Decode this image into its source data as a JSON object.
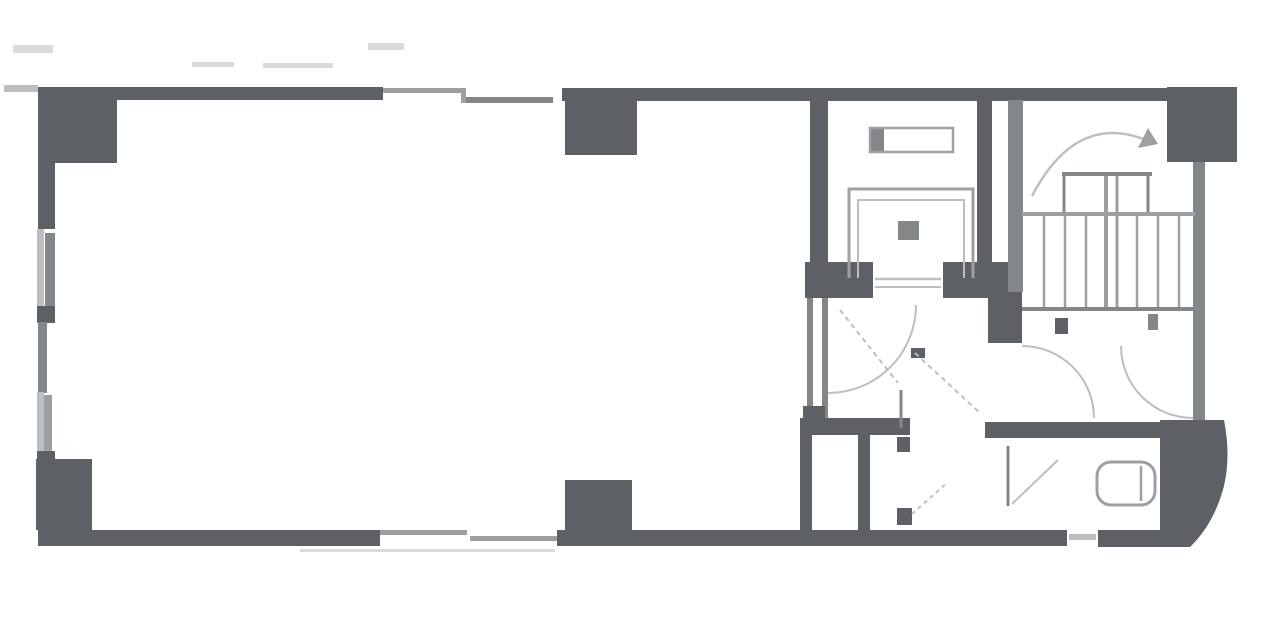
{
  "canvas": {
    "width": 1280,
    "height": 632,
    "background": "#ffffff"
  },
  "colors": {
    "dark": "#5d6064",
    "med": "#84878a",
    "medlt": "#9da0a3",
    "lt": "#bcbfc2",
    "faint": "#d8dadc",
    "white": "#ffffff"
  },
  "walls": [
    {
      "name": "column-top-left",
      "x": 38,
      "y": 87,
      "w": 79,
      "h": 76,
      "c": "dark"
    },
    {
      "name": "wall-left-upper",
      "x": 38,
      "y": 163,
      "w": 17,
      "h": 66,
      "c": "dark"
    },
    {
      "name": "window-left-upper-outer",
      "x": 37,
      "y": 229,
      "w": 7,
      "h": 80,
      "c": "lt"
    },
    {
      "name": "window-left-upper-inner",
      "x": 45,
      "y": 233,
      "w": 10,
      "h": 74,
      "c": "med"
    },
    {
      "name": "wall-left-jamb-upper",
      "x": 37,
      "y": 306,
      "w": 18,
      "h": 17,
      "c": "dark"
    },
    {
      "name": "wall-left-middle",
      "x": 38,
      "y": 322,
      "w": 9,
      "h": 71,
      "c": "med"
    },
    {
      "name": "window-left-lower-outer",
      "x": 37,
      "y": 392,
      "w": 7,
      "h": 64,
      "c": "lt"
    },
    {
      "name": "window-left-lower-inner",
      "x": 44,
      "y": 395,
      "w": 8,
      "h": 59,
      "c": "medlt"
    },
    {
      "name": "wall-left-jamb-lower",
      "x": 37,
      "y": 451,
      "w": 18,
      "h": 13,
      "c": "dark"
    },
    {
      "name": "column-bottom-left",
      "x": 36,
      "y": 459,
      "w": 56,
      "h": 71,
      "c": "dark"
    },
    {
      "name": "wall-top-left-segment",
      "x": 38,
      "y": 87,
      "w": 345,
      "h": 13,
      "c": "dark"
    },
    {
      "name": "wall-top-right-segment",
      "x": 562,
      "y": 88,
      "w": 605,
      "h": 13,
      "c": "dark"
    },
    {
      "name": "column-top-middle",
      "x": 565,
      "y": 88,
      "w": 72,
      "h": 67,
      "c": "dark"
    },
    {
      "name": "column-top-right",
      "x": 1167,
      "y": 87,
      "w": 70,
      "h": 75,
      "c": "dark"
    },
    {
      "name": "wall-bottom-left-segment",
      "x": 38,
      "y": 530,
      "w": 342,
      "h": 16,
      "c": "dark"
    },
    {
      "name": "wall-bottom-middle-segment",
      "x": 557,
      "y": 530,
      "w": 510,
      "h": 16,
      "c": "dark"
    },
    {
      "name": "wall-bottom-vent-gap",
      "x": 1067,
      "y": 530,
      "w": 31,
      "h": 16,
      "c": "white"
    },
    {
      "name": "wall-bottom-vent-line",
      "x": 1069,
      "y": 534,
      "w": 27,
      "h": 6,
      "c": "lt"
    },
    {
      "name": "wall-bottom-right-segment",
      "x": 1098,
      "y": 530,
      "w": 64,
      "h": 17,
      "c": "dark"
    },
    {
      "name": "column-bottom-middle",
      "x": 565,
      "y": 480,
      "w": 67,
      "h": 53,
      "c": "dark"
    },
    {
      "name": "wall-elevator-left",
      "x": 810,
      "y": 100,
      "w": 18,
      "h": 167,
      "c": "dark"
    },
    {
      "name": "wall-elevator-right",
      "x": 977,
      "y": 100,
      "w": 15,
      "h": 162,
      "c": "dark"
    },
    {
      "name": "elevator-door-jamb-left",
      "x": 805,
      "y": 262,
      "w": 68,
      "h": 36,
      "c": "dark"
    },
    {
      "name": "elevator-door-jamb-right",
      "x": 943,
      "y": 262,
      "w": 67,
      "h": 36,
      "c": "dark"
    },
    {
      "name": "wall-hall-left-a",
      "x": 807,
      "y": 298,
      "w": 6,
      "h": 122,
      "c": "med"
    },
    {
      "name": "wall-hall-left-b",
      "x": 822,
      "y": 298,
      "w": 6,
      "h": 122,
      "c": "med"
    },
    {
      "name": "wall-hall-junction",
      "x": 803,
      "y": 406,
      "w": 22,
      "h": 14,
      "c": "dark"
    },
    {
      "name": "wall-bathroom-top-left",
      "x": 800,
      "y": 418,
      "w": 110,
      "h": 17,
      "c": "dark"
    },
    {
      "name": "wall-anteroom-left",
      "x": 800,
      "y": 435,
      "w": 12,
      "h": 95,
      "c": "dark"
    },
    {
      "name": "wall-bathroom-left",
      "x": 858,
      "y": 435,
      "w": 12,
      "h": 95,
      "c": "dark"
    },
    {
      "name": "bathroom-partition-top",
      "x": 897,
      "y": 437,
      "w": 13,
      "h": 15,
      "c": "dark"
    },
    {
      "name": "bathroom-partition-bottom",
      "x": 897,
      "y": 508,
      "w": 15,
      "h": 17,
      "c": "dark"
    },
    {
      "name": "wall-bathroom-top-right",
      "x": 985,
      "y": 422,
      "w": 222,
      "h": 16,
      "c": "dark"
    },
    {
      "name": "wall-stair-left",
      "x": 1008,
      "y": 100,
      "w": 15,
      "h": 192,
      "c": "med"
    },
    {
      "name": "wall-stair-left-block",
      "x": 988,
      "y": 292,
      "w": 34,
      "h": 51,
      "c": "dark"
    },
    {
      "name": "wall-right",
      "x": 1193,
      "y": 162,
      "w": 12,
      "h": 260,
      "c": "med"
    },
    {
      "name": "balcony-stub-left",
      "x": 4,
      "y": 85,
      "w": 34,
      "h": 7,
      "c": "lt"
    },
    {
      "name": "dimension-mark-1",
      "x": 13,
      "y": 45,
      "w": 40,
      "h": 8,
      "c": "faint"
    },
    {
      "name": "dimension-mark-2",
      "x": 368,
      "y": 43,
      "w": 36,
      "h": 7,
      "c": "faint"
    },
    {
      "name": "dimension-mark-3",
      "x": 192,
      "y": 62,
      "w": 42,
      "h": 5,
      "c": "faint"
    },
    {
      "name": "dimension-mark-4",
      "x": 263,
      "y": 63,
      "w": 70,
      "h": 5,
      "c": "faint"
    },
    {
      "name": "window-top-outer",
      "x": 383,
      "y": 88,
      "w": 82,
      "h": 5,
      "c": "medlt"
    },
    {
      "name": "window-top-inner",
      "x": 463,
      "y": 97,
      "w": 90,
      "h": 6,
      "c": "med"
    },
    {
      "name": "window-top-joint",
      "x": 461,
      "y": 88,
      "w": 5,
      "h": 15,
      "c": "medlt"
    },
    {
      "name": "window-bottom-outer",
      "x": 380,
      "y": 530,
      "w": 87,
      "h": 5,
      "c": "medlt"
    },
    {
      "name": "window-bottom-inner",
      "x": 470,
      "y": 536,
      "w": 87,
      "h": 5,
      "c": "medlt"
    },
    {
      "name": "window-bottom-under-line",
      "x": 300,
      "y": 549,
      "w": 255,
      "h": 3,
      "c": "faint"
    },
    {
      "name": "hall-door-stub",
      "x": 911,
      "y": 348,
      "w": 14,
      "h": 10,
      "c": "dark"
    },
    {
      "name": "stair-door-stub-left",
      "x": 1055,
      "y": 318,
      "w": 13,
      "h": 16,
      "c": "dark"
    },
    {
      "name": "stair-door-stub-right",
      "x": 1148,
      "y": 314,
      "w": 10,
      "h": 16,
      "c": "med"
    },
    {
      "name": "elevator-handle",
      "x": 898,
      "y": 221,
      "w": 21,
      "h": 19,
      "c": "med"
    },
    {
      "name": "counterweight-cap",
      "x": 870,
      "y": 128,
      "w": 14,
      "h": 24,
      "c": "med"
    }
  ],
  "vectors": [
    {
      "name": "bathroom-corner-block",
      "tag": "path",
      "attrs": {
        "d": "M1160,420 L1224,420 Q1231,455 1224,486 Q1214,524 1190,547 L1160,547 Z",
        "fill": "dark",
        "stroke": "none"
      }
    },
    {
      "name": "elevator-counterweight",
      "tag": "rect",
      "attrs": {
        "x": "870",
        "y": "128",
        "width": "83",
        "height": "24",
        "fill": "none",
        "stroke": "medlt",
        "stroke-width": "2.5"
      }
    },
    {
      "name": "elevator-car-outer",
      "tag": "path",
      "attrs": {
        "d": "M849,278 V189 H973 V278",
        "fill": "none",
        "stroke": "medlt",
        "stroke-width": "3"
      }
    },
    {
      "name": "elevator-car-inner",
      "tag": "path",
      "attrs": {
        "d": "M858,278 V200 H964 V278",
        "fill": "none",
        "stroke": "lt",
        "stroke-width": "2"
      }
    },
    {
      "name": "elevator-door-line-1",
      "tag": "line",
      "attrs": {
        "x1": "875",
        "y1": "279",
        "x2": "941",
        "y2": "279",
        "stroke": "lt",
        "stroke-width": "2.5"
      }
    },
    {
      "name": "elevator-door-line-2",
      "tag": "line",
      "attrs": {
        "x1": "875",
        "y1": "287",
        "x2": "941",
        "y2": "287",
        "stroke": "lt",
        "stroke-width": "2"
      }
    },
    {
      "name": "stair-core-top",
      "tag": "line",
      "attrs": {
        "x1": "1062",
        "y1": "174",
        "x2": "1152",
        "y2": "174",
        "stroke": "med",
        "stroke-width": "4"
      }
    },
    {
      "name": "stair-core-left",
      "tag": "line",
      "attrs": {
        "x1": "1064",
        "y1": "174",
        "x2": "1064",
        "y2": "216",
        "stroke": "med",
        "stroke-width": "3"
      }
    },
    {
      "name": "stair-core-right",
      "tag": "line",
      "attrs": {
        "x1": "1148",
        "y1": "174",
        "x2": "1148",
        "y2": "216",
        "stroke": "med",
        "stroke-width": "3"
      }
    },
    {
      "name": "stair-landing-line",
      "tag": "line",
      "attrs": {
        "x1": "1022",
        "y1": "214",
        "x2": "1195",
        "y2": "214",
        "stroke": "medlt",
        "stroke-width": "4"
      }
    },
    {
      "name": "stair-divider-a",
      "tag": "line",
      "attrs": {
        "x1": "1106",
        "y1": "176",
        "x2": "1106",
        "y2": "311",
        "stroke": "medlt",
        "stroke-width": "4"
      }
    },
    {
      "name": "stair-divider-b",
      "tag": "line",
      "attrs": {
        "x1": "1117",
        "y1": "176",
        "x2": "1117",
        "y2": "311",
        "stroke": "medlt",
        "stroke-width": "3"
      }
    },
    {
      "name": "stair-tread-l1",
      "tag": "line",
      "attrs": {
        "x1": "1044",
        "y1": "216",
        "x2": "1044",
        "y2": "308",
        "stroke": "medlt",
        "stroke-width": "2.5"
      }
    },
    {
      "name": "stair-tread-l2",
      "tag": "line",
      "attrs": {
        "x1": "1065",
        "y1": "216",
        "x2": "1065",
        "y2": "308",
        "stroke": "medlt",
        "stroke-width": "2.5"
      }
    },
    {
      "name": "stair-tread-l3",
      "tag": "line",
      "attrs": {
        "x1": "1086",
        "y1": "216",
        "x2": "1086",
        "y2": "308",
        "stroke": "medlt",
        "stroke-width": "2.5"
      }
    },
    {
      "name": "stair-tread-r1",
      "tag": "line",
      "attrs": {
        "x1": "1137",
        "y1": "216",
        "x2": "1137",
        "y2": "308",
        "stroke": "medlt",
        "stroke-width": "2.5"
      }
    },
    {
      "name": "stair-tread-r2",
      "tag": "line",
      "attrs": {
        "x1": "1158",
        "y1": "216",
        "x2": "1158",
        "y2": "308",
        "stroke": "medlt",
        "stroke-width": "2.5"
      }
    },
    {
      "name": "stair-tread-r3",
      "tag": "line",
      "attrs": {
        "x1": "1179",
        "y1": "216",
        "x2": "1179",
        "y2": "308",
        "stroke": "medlt",
        "stroke-width": "2.5"
      }
    },
    {
      "name": "stair-bottom-line",
      "tag": "line",
      "attrs": {
        "x1": "1022",
        "y1": "309",
        "x2": "1195",
        "y2": "309",
        "stroke": "med",
        "stroke-width": "4"
      }
    },
    {
      "name": "stair-direction-arrow",
      "tag": "path",
      "attrs": {
        "d": "M1032,196 Q1076,112 1146,140",
        "fill": "none",
        "stroke": "lt",
        "stroke-width": "2.5"
      }
    },
    {
      "name": "stair-arrow-head",
      "tag": "polygon",
      "attrs": {
        "points": "1148,128 1158,144 1138,148",
        "fill": "medlt",
        "stroke": "none"
      }
    },
    {
      "name": "hall-door-arc-left",
      "tag": "path",
      "attrs": {
        "d": "M1022,346 A72,72 0 0 1 1094,418",
        "fill": "none",
        "stroke": "lt",
        "stroke-width": "2"
      }
    },
    {
      "name": "hall-door-arc-right",
      "tag": "path",
      "attrs": {
        "d": "M1121,346 A72,72 0 0 0 1193,418",
        "fill": "none",
        "stroke": "lt",
        "stroke-width": "2"
      }
    },
    {
      "name": "elevator-hall-door-arc",
      "tag": "path",
      "attrs": {
        "d": "M916,305 A88,88 0 0 1 828,393",
        "fill": "none",
        "stroke": "lt",
        "stroke-width": "2"
      }
    },
    {
      "name": "elevator-hall-door-leaf-diagonal",
      "tag": "line",
      "attrs": {
        "x1": "840",
        "y1": "310",
        "x2": "898",
        "y2": "383",
        "stroke": "lt",
        "stroke-width": "2",
        "stroke-dasharray": "5,4"
      }
    },
    {
      "name": "elevator-hall-door-leaf",
      "tag": "line",
      "attrs": {
        "x1": "901",
        "y1": "390",
        "x2": "901",
        "y2": "428",
        "stroke": "med",
        "stroke-width": "3"
      }
    },
    {
      "name": "hall-door-b-diagonal",
      "tag": "line",
      "attrs": {
        "x1": "915",
        "y1": "353",
        "x2": "980",
        "y2": "413",
        "stroke": "lt",
        "stroke-width": "2",
        "stroke-dasharray": "5,4"
      }
    },
    {
      "name": "stall-door-leaf",
      "tag": "line",
      "attrs": {
        "x1": "1008",
        "y1": "446",
        "x2": "1008",
        "y2": "506",
        "stroke": "med",
        "stroke-width": "3"
      }
    },
    {
      "name": "stall-door-swing",
      "tag": "line",
      "attrs": {
        "x1": "1012",
        "y1": "504",
        "x2": "1058",
        "y2": "460",
        "stroke": "lt",
        "stroke-width": "2"
      }
    },
    {
      "name": "stall-door-swing-2",
      "tag": "line",
      "attrs": {
        "x1": "912",
        "y1": "514",
        "x2": "948",
        "y2": "482",
        "stroke": "lt",
        "stroke-width": "2",
        "stroke-dasharray": "4,4"
      }
    },
    {
      "name": "toilet-bowl",
      "tag": "rect",
      "attrs": {
        "x": "1097",
        "y": "462",
        "width": "58",
        "height": "43",
        "rx": "14",
        "fill": "white",
        "stroke": "medlt",
        "stroke-width": "3"
      }
    },
    {
      "name": "toilet-tank-line",
      "tag": "line",
      "attrs": {
        "x1": "1141",
        "y1": "466",
        "x2": "1141",
        "y2": "501",
        "stroke": "medlt",
        "stroke-width": "2.5"
      }
    }
  ]
}
